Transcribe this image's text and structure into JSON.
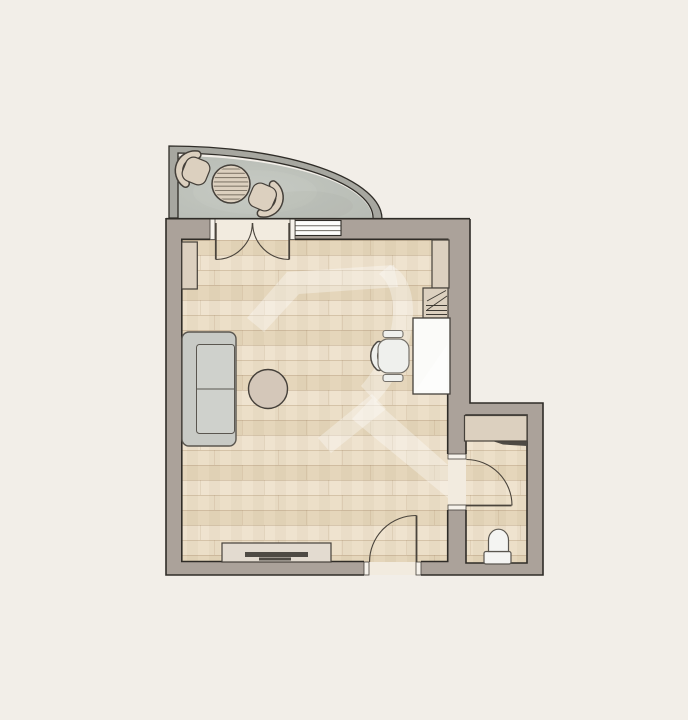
{
  "meta": {
    "type": "architectural-floor-plan",
    "view": "top-down studio apartment plan with curved balcony, living room and bathroom",
    "watermark": "translucent R-shaped logo over wood floor"
  },
  "palette": {
    "bg": "#f2eee8",
    "wall_fill": "#aba29a",
    "wall_line": "#2f2c27",
    "rail_fill": "#a7a7a0",
    "balcony_floor": "#b7bbb4",
    "balcony_floor_hi": "#c3c7c0",
    "wood_a": "#ecdfc8",
    "wood_b": "#e5d6bb",
    "wood_c": "#efe3cf",
    "wood_joint": "rgba(150,118,82,0.30)",
    "wood_joint_soft": "rgba(150,118,82,0.16)",
    "wood_band": "rgba(139,108,76,0.05)",
    "threshold": "#f2ebdf",
    "frame_fill": "#f6f2eb",
    "window_fill": "#fdfdfb",
    "glass_line": "#6f6b64",
    "door_line": "#4a443c",
    "furn_beige": "#dcd0bf",
    "furn_line": "#45403a",
    "sofa_fill": "#c8cac5",
    "sofa_cushion": "#cfd1cc",
    "sofa_line": "#5a564f",
    "round_table": "#d4c7b9",
    "tv_stand": "#e3dbd0",
    "dark_bar": "#4e4a44",
    "desk_fill": "#fbfbf9",
    "chair_fill": "#eff0ed",
    "chair_line": "#75716a",
    "toilet_fill": "#f4f4f2",
    "hatch_line": "#3e3a33",
    "watermark": "#ffffff"
  },
  "rooms": [
    {
      "id": "living-room",
      "floor": "wood planks",
      "furniture": [
        "sofa",
        "coffee-table",
        "tv-stand-with-tv",
        "desk",
        "desk-chair",
        "wardrobe",
        "hatched-shelf-unit",
        "side-cabinet"
      ]
    },
    {
      "id": "balcony",
      "floor": "concrete",
      "shape": "quarter-circle",
      "furniture": [
        "round-slatted-table",
        "chair",
        "chair"
      ]
    },
    {
      "id": "bathroom",
      "floor": "wood planks",
      "furniture": [
        "cabinet",
        "toilet"
      ]
    }
  ],
  "openings": [
    {
      "id": "balcony-french-doors",
      "type": "double-swing-door"
    },
    {
      "id": "balcony-window",
      "type": "fixed-window"
    },
    {
      "id": "entrance-door",
      "type": "swing-door"
    },
    {
      "id": "bathroom-door",
      "type": "swing-door"
    }
  ]
}
